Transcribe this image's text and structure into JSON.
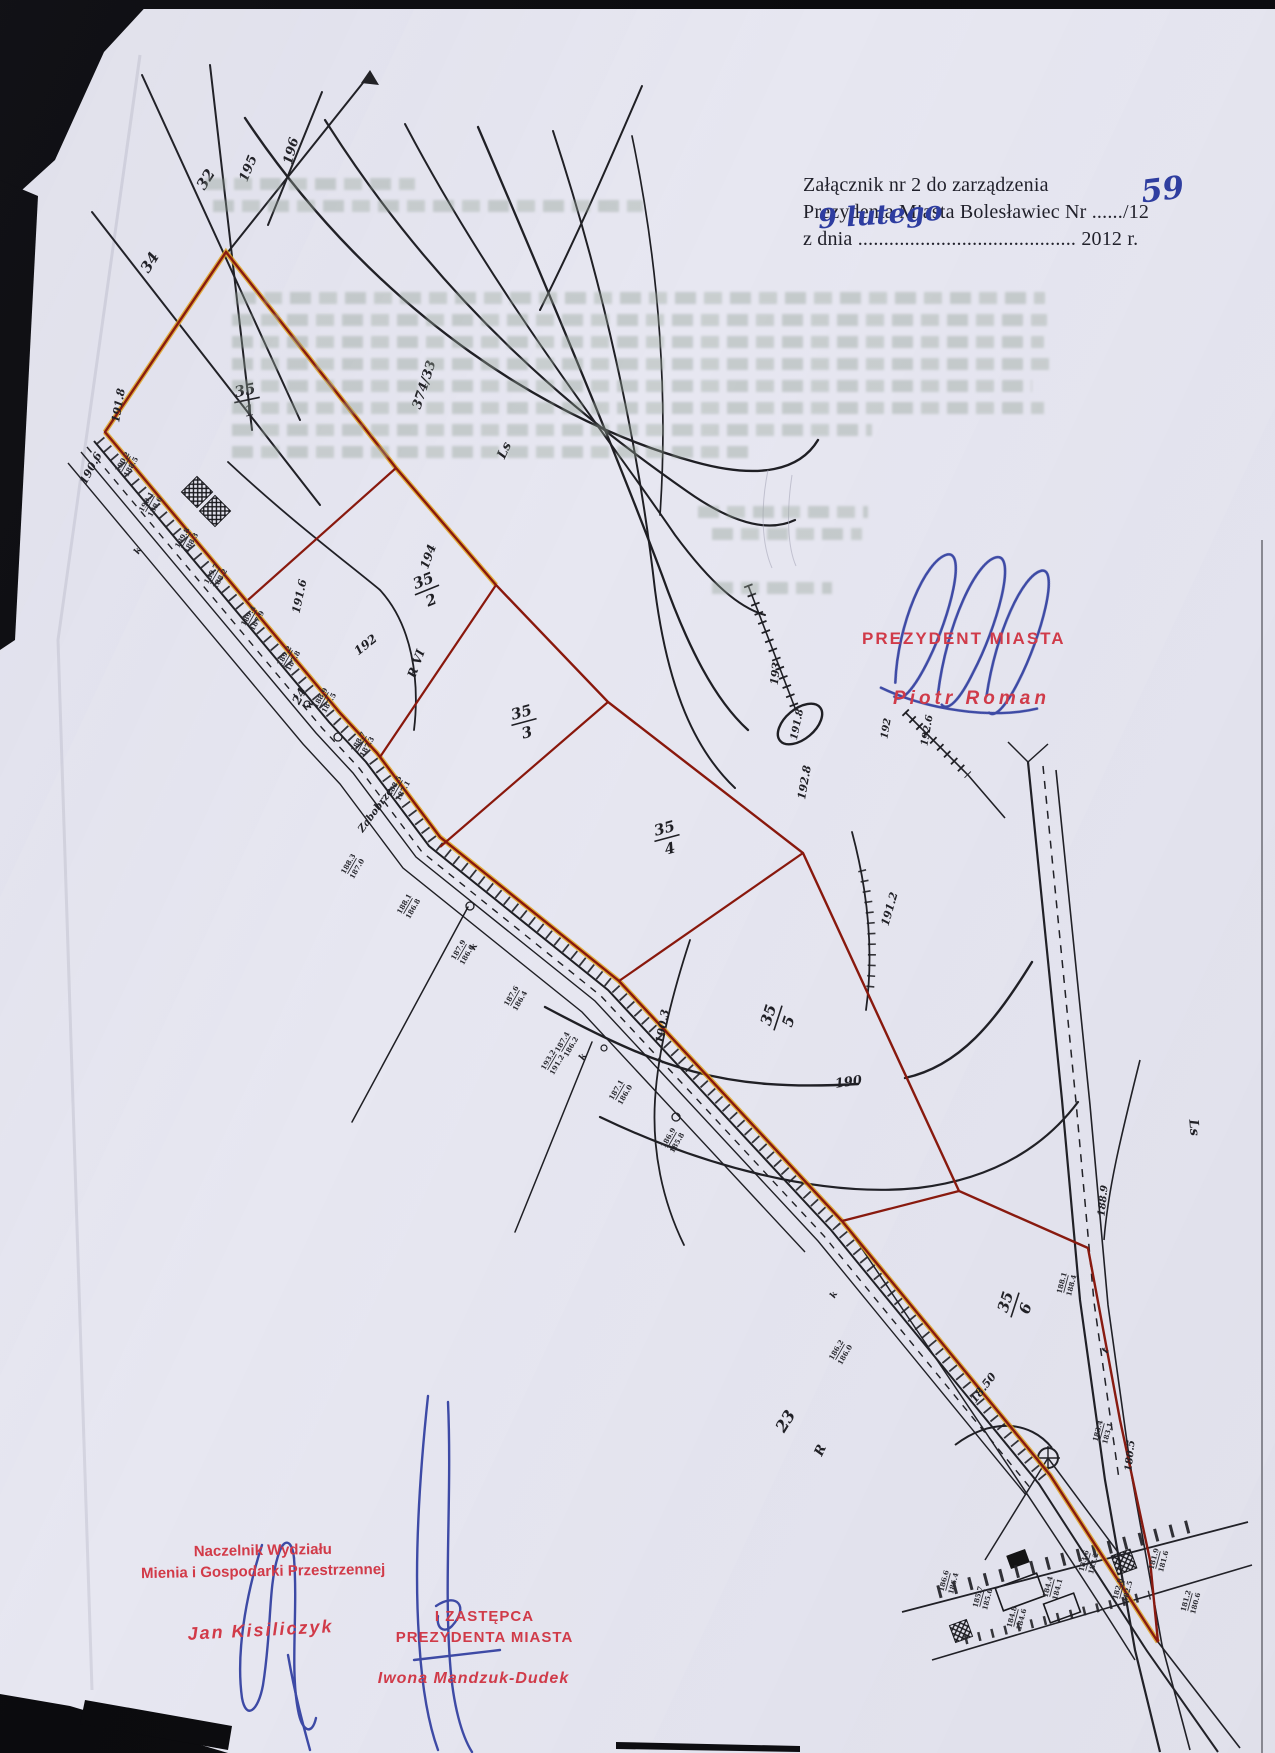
{
  "page": {
    "background": "#e7e7f1"
  },
  "header": {
    "line1": "Załącznik nr 2 do zarządzenia",
    "line2_prefix": "Prezydenta Miasta Bolesławiec Nr",
    "line2_dots": "......",
    "line2_suffix": "/12",
    "line2_handwritten": "59",
    "line3_prefix": "z dnia",
    "line3_dots": "..........................................",
    "line3_suffix": "2012 r.",
    "line3_handwritten": "9 lutego"
  },
  "stamps": {
    "president_title": "PREZYDENT MIASTA",
    "president_name": "Piotr Roman",
    "department_head_line1": "Naczelnik Wydziału",
    "department_head_line2": "Mienia i Gospodarki Przestrzennej",
    "department_head_name": "Jan Kisiliczyk",
    "deputy_line1": "I ZASTĘPCA",
    "deputy_line2": "PREZYDENTA MIASTA",
    "deputy_name": "Iwona Mandzuk-Dudek"
  },
  "map": {
    "parcel_labels": [
      {
        "n": "35",
        "d": "1",
        "x": 247,
        "y": 400,
        "r": -12
      },
      {
        "n": "35",
        "d": "2",
        "x": 427,
        "y": 590,
        "r": -22
      },
      {
        "n": "35",
        "d": "3",
        "x": 524,
        "y": 722,
        "r": -15
      },
      {
        "n": "35",
        "d": "4",
        "x": 667,
        "y": 838,
        "r": -15
      },
      {
        "n": "35",
        "d": "5",
        "x": 778,
        "y": 1018,
        "r": -72
      },
      {
        "n": "35",
        "d": "6",
        "x": 1015,
        "y": 1305,
        "r": -72
      }
    ],
    "labels": [
      {
        "t": "196",
        "x": 295,
        "y": 152,
        "r": -75,
        "s": 13
      },
      {
        "t": "195",
        "x": 252,
        "y": 170,
        "r": -68,
        "s": 13
      },
      {
        "t": "32",
        "x": 210,
        "y": 182,
        "r": -58,
        "s": 15
      },
      {
        "t": "34",
        "x": 154,
        "y": 265,
        "r": -58,
        "s": 15
      },
      {
        "t": "374/33",
        "x": 428,
        "y": 386,
        "r": -72,
        "s": 13
      },
      {
        "t": "191.8",
        "x": 122,
        "y": 406,
        "r": -80,
        "s": 11
      },
      {
        "t": "190.6",
        "x": 94,
        "y": 470,
        "r": -62,
        "s": 11
      },
      {
        "t": "Ls",
        "x": 508,
        "y": 452,
        "r": -65,
        "s": 13
      },
      {
        "t": "194",
        "x": 432,
        "y": 558,
        "r": -70,
        "s": 12
      },
      {
        "t": "191.6",
        "x": 303,
        "y": 597,
        "r": -78,
        "s": 11
      },
      {
        "t": "192",
        "x": 368,
        "y": 648,
        "r": -38,
        "s": 12
      },
      {
        "t": "R VI",
        "x": 420,
        "y": 665,
        "r": -70,
        "s": 12
      },
      {
        "t": "24",
        "x": 303,
        "y": 698,
        "r": -62,
        "s": 12
      },
      {
        "t": "Zabobrze",
        "x": 378,
        "y": 812,
        "r": -54,
        "s": 10
      },
      {
        "t": "193",
        "x": 779,
        "y": 674,
        "r": -84,
        "s": 11
      },
      {
        "t": "191.8",
        "x": 800,
        "y": 725,
        "r": -78,
        "s": 10
      },
      {
        "t": "192",
        "x": 889,
        "y": 729,
        "r": -80,
        "s": 10
      },
      {
        "t": "192.6",
        "x": 930,
        "y": 731,
        "r": -80,
        "s": 10
      },
      {
        "t": "192.8",
        "x": 808,
        "y": 783,
        "r": -80,
        "s": 11
      },
      {
        "t": "191.2",
        "x": 893,
        "y": 910,
        "r": -74,
        "s": 11
      },
      {
        "t": "190.3",
        "x": 666,
        "y": 1027,
        "r": -80,
        "s": 11
      },
      {
        "t": "190",
        "x": 849,
        "y": 1086,
        "r": -8,
        "s": 13
      },
      {
        "t": "Ls",
        "x": 1190,
        "y": 1128,
        "r": 85,
        "s": 13
      },
      {
        "t": "188.9",
        "x": 1106,
        "y": 1201,
        "r": -84,
        "s": 10
      },
      {
        "t": "18.50",
        "x": 986,
        "y": 1390,
        "r": -52,
        "s": 11
      },
      {
        "t": "180.5",
        "x": 1133,
        "y": 1456,
        "r": -84,
        "s": 10
      },
      {
        "t": "23",
        "x": 790,
        "y": 1424,
        "r": -58,
        "s": 16
      },
      {
        "t": "R",
        "x": 824,
        "y": 1452,
        "r": -65,
        "s": 13
      },
      {
        "t": "t",
        "x": 1108,
        "y": 1352,
        "r": -60,
        "s": 10
      },
      {
        "t": "w",
        "x": 312,
        "y": 706,
        "r": -60,
        "s": 9
      },
      {
        "t": "k",
        "x": 140,
        "y": 552,
        "r": -60,
        "s": 9
      },
      {
        "t": "k",
        "x": 476,
        "y": 948,
        "r": -60,
        "s": 9
      },
      {
        "t": "k",
        "x": 585,
        "y": 1058,
        "r": -60,
        "s": 9
      },
      {
        "t": "k",
        "x": 836,
        "y": 1296,
        "r": -60,
        "s": 9
      }
    ],
    "point_elevation_pairs": [
      {
        "top": "190.2",
        "bottom": "188.5",
        "x": 126,
        "y": 464,
        "r": -60
      },
      {
        "top": "190.1",
        "bottom": "188.6",
        "x": 150,
        "y": 504,
        "r": -60
      },
      {
        "top": "189.8",
        "bottom": "188.3",
        "x": 186,
        "y": 540,
        "r": -60
      },
      {
        "top": "189.7",
        "bottom": "188.2",
        "x": 215,
        "y": 576,
        "r": -60
      },
      {
        "top": "189.4",
        "bottom": "187.9",
        "x": 252,
        "y": 618,
        "r": -60
      },
      {
        "top": "189.2",
        "bottom": "187.8",
        "x": 288,
        "y": 658,
        "r": -60
      },
      {
        "top": "188.9",
        "bottom": "187.5",
        "x": 324,
        "y": 700,
        "r": -60
      },
      {
        "top": "188.7",
        "bottom": "187.3",
        "x": 362,
        "y": 744,
        "r": -60
      },
      {
        "top": "188.5",
        "bottom": "187.1",
        "x": 398,
        "y": 788,
        "r": -60
      },
      {
        "top": "188.3",
        "bottom": "187.0",
        "x": 352,
        "y": 866,
        "r": -60
      },
      {
        "top": "188.1",
        "bottom": "186.8",
        "x": 408,
        "y": 906,
        "r": -60
      },
      {
        "top": "187.9",
        "bottom": "186.6",
        "x": 462,
        "y": 952,
        "r": -60
      },
      {
        "top": "187.6",
        "bottom": "186.4",
        "x": 515,
        "y": 998,
        "r": -60
      },
      {
        "top": "193.2",
        "bottom": "191.2",
        "x": 552,
        "y": 1062,
        "r": -60
      },
      {
        "top": "187.4",
        "bottom": "186.2",
        "x": 566,
        "y": 1044,
        "r": -60
      },
      {
        "top": "187.1",
        "bottom": "186.0",
        "x": 620,
        "y": 1092,
        "r": -60
      },
      {
        "top": "186.9",
        "bottom": "185.8",
        "x": 672,
        "y": 1140,
        "r": -60
      },
      {
        "top": "188.1",
        "bottom": "188.4",
        "x": 1066,
        "y": 1284,
        "r": -75
      },
      {
        "top": "186.2",
        "bottom": "186.0",
        "x": 840,
        "y": 1352,
        "r": -60
      },
      {
        "top": "183.4",
        "bottom": "183.1",
        "x": 1102,
        "y": 1432,
        "r": -75
      },
      {
        "top": "186.6",
        "bottom": "186.4",
        "x": 948,
        "y": 1582,
        "r": -75
      },
      {
        "top": "185.7",
        "bottom": "185.6",
        "x": 982,
        "y": 1598,
        "r": -75
      },
      {
        "top": "184.8",
        "bottom": "184.6",
        "x": 1016,
        "y": 1618,
        "r": -75
      },
      {
        "top": "184.4",
        "bottom": "184.1",
        "x": 1052,
        "y": 1588,
        "r": -75
      },
      {
        "top": "183.6",
        "bottom": "183.2",
        "x": 1088,
        "y": 1562,
        "r": -75
      },
      {
        "top": "182.8",
        "bottom": "182.5",
        "x": 1122,
        "y": 1590,
        "r": -75
      },
      {
        "top": "181.9",
        "bottom": "181.6",
        "x": 1158,
        "y": 1560,
        "r": -75
      },
      {
        "top": "181.2",
        "bottom": "180.6",
        "x": 1190,
        "y": 1602,
        "r": -75
      }
    ]
  },
  "colors": {
    "boundary_red": "#8a180c",
    "boundary_yellow": "#e2a213",
    "stamp_red": "#d23a48",
    "ink_blue": "#2e3da0",
    "map_ink": "#1f1f24"
  }
}
